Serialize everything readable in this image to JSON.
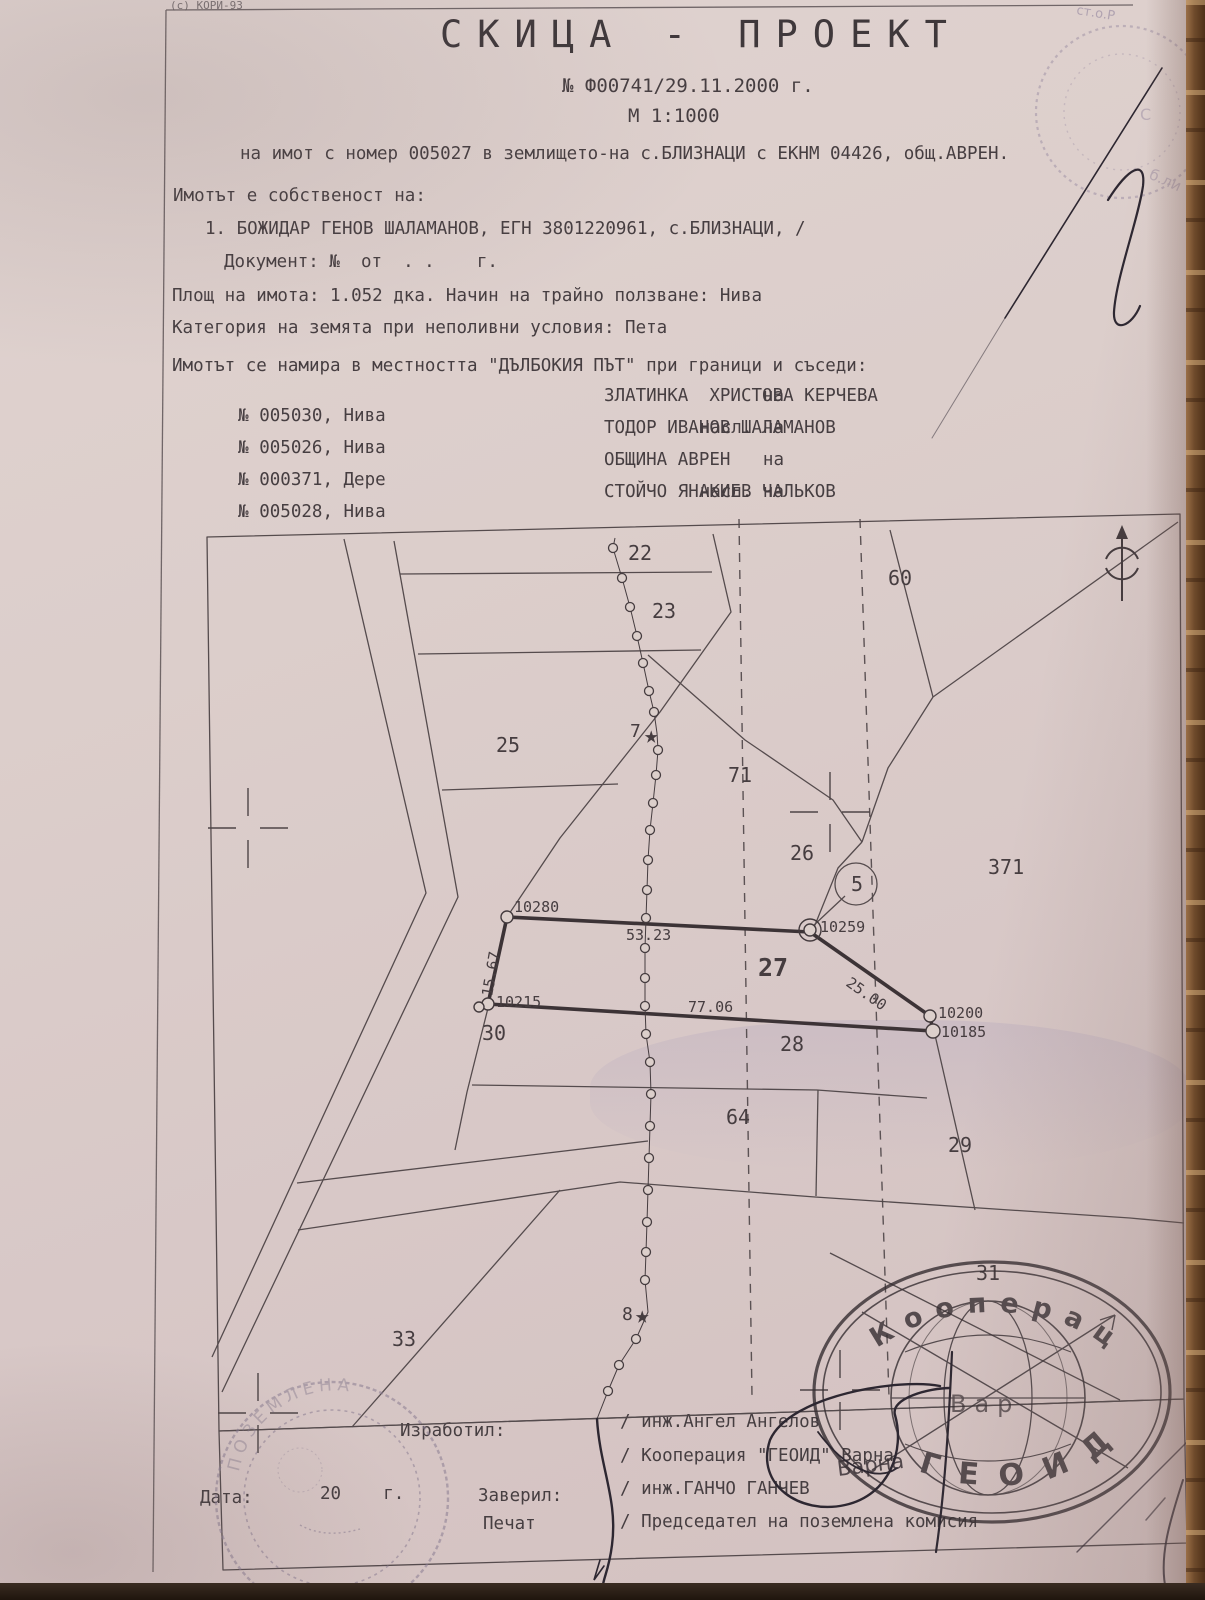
{
  "page": {
    "credit": "(с) КОРИ-93",
    "corner_fragment": "ст.о.Р",
    "stamp_fragment_1": "С",
    "stamp_fragment_2": "б.ли"
  },
  "header": {
    "title": "СКИЦА - ПРОЕКТ",
    "number_line": "№ Ф00741/29.11.2000 г.",
    "scale_line": "М 1:1000",
    "subject_line": "на имот с номер 005027 в землището-на с.БЛИЗНАЦИ с ЕКНМ 04426, общ.АВРЕН."
  },
  "ownership": {
    "intro": "Имотът е собственост на:",
    "owner_line": "1. БОЖИДАР ГЕНОВ ШАЛАМАНОВ, ЕГН 3801220961, с.БЛИЗНАЦИ, /",
    "document_line": "Документ: №  от  . .    г.",
    "area_line": "Площ на имота: 1.052 дка. Начин на трайно ползване: Нива",
    "category_line": "Категория на земята при неполивни условия: Пета"
  },
  "location": {
    "intro": "Имотът се намира в местността \"ДЪЛБОКИЯ ПЪТ\" при граници и съседи:",
    "neighbors": [
      {
        "num": "№ 005030, Нива",
        "rel": "на",
        "name": "ЗЛАТИНКА  ХРИСТОВА КЕРЧЕВА"
      },
      {
        "num": "№ 005026, Нива",
        "rel": "насл. на",
        "name": "ТОДОР ИВАНОВ ШАЛАМАНОВ"
      },
      {
        "num": "№ 000371, Дере",
        "rel": "на",
        "name": "ОБЩИНА АВРЕН"
      },
      {
        "num": "№ 005028, Нива",
        "rel": "насл. на",
        "name": "СТОЙЧО ЯНАКИЕВ ЧАЛЬКОВ"
      }
    ]
  },
  "map": {
    "parcel_number": "005027",
    "labels": [
      {
        "t": "22",
        "x": 628,
        "y": 560,
        "fs": 20
      },
      {
        "t": "23",
        "x": 652,
        "y": 618,
        "fs": 20
      },
      {
        "t": "25",
        "x": 496,
        "y": 752,
        "fs": 20
      },
      {
        "t": "60",
        "x": 888,
        "y": 585,
        "fs": 20
      },
      {
        "t": "71",
        "x": 728,
        "y": 782,
        "fs": 20
      },
      {
        "t": "26",
        "x": 790,
        "y": 860,
        "fs": 20
      },
      {
        "t": "371",
        "x": 988,
        "y": 874,
        "fs": 20
      },
      {
        "t": "5",
        "x": 851,
        "y": 891,
        "fs": 20
      },
      {
        "t": "27",
        "x": 758,
        "y": 976,
        "fs": 25,
        "b": 1
      },
      {
        "t": "28",
        "x": 780,
        "y": 1051,
        "fs": 20
      },
      {
        "t": "30",
        "x": 482,
        "y": 1040,
        "fs": 20
      },
      {
        "t": "64",
        "x": 726,
        "y": 1124,
        "fs": 20
      },
      {
        "t": "29",
        "x": 948,
        "y": 1152,
        "fs": 20
      },
      {
        "t": "31",
        "x": 976,
        "y": 1280,
        "fs": 20
      },
      {
        "t": "33",
        "x": 392,
        "y": 1346,
        "fs": 20
      },
      {
        "t": "7",
        "x": 630,
        "y": 737,
        "fs": 18
      },
      {
        "t": "8",
        "x": 622,
        "y": 1320,
        "fs": 18
      },
      {
        "t": "★",
        "x": 644,
        "y": 743,
        "fs": 24
      },
      {
        "t": "★",
        "x": 635,
        "y": 1323,
        "fs": 24
      },
      {
        "t": "10280",
        "x": 514,
        "y": 912,
        "fs": 15
      },
      {
        "t": "10259",
        "x": 820,
        "y": 932,
        "fs": 15
      },
      {
        "t": "10200",
        "x": 938,
        "y": 1018,
        "fs": 15
      },
      {
        "t": "10185",
        "x": 941,
        "y": 1037,
        "fs": 15
      },
      {
        "t": "10215",
        "x": 496,
        "y": 1007,
        "fs": 15
      },
      {
        "t": "53.23",
        "x": 626,
        "y": 940,
        "fs": 15
      },
      {
        "t": "77.06",
        "x": 688,
        "y": 1012,
        "fs": 15
      },
      {
        "t": "15.67",
        "x": 492,
        "y": 997,
        "fs": 15,
        "rot": -80
      },
      {
        "t": "25.00",
        "x": 845,
        "y": 985,
        "fs": 15,
        "rot": 35
      }
    ]
  },
  "footer": {
    "made_by_label": "Изработил:",
    "date_label": "Дата:",
    "date_value": "20    г.",
    "verified_label": "Заверил:",
    "stamp_label": "Печат",
    "made_by_name": "/ инж.Ангел Ангелов",
    "made_by_org": "/ Кооперация \"ГЕОИД\" Варна",
    "verified_name": "/ инж.ГАНЧО ГАНЧЕВ",
    "chairman_line": "/ Председател на поземлена комисия"
  },
  "stamps": {
    "geoid_top": "Кооперац",
    "geoid_bottom": "ГЕОИД",
    "geoid_middle": "Вар",
    "geoid_side": "Варна",
    "left_stamp_arc": "ПОЗЕМЛЕНА"
  }
}
